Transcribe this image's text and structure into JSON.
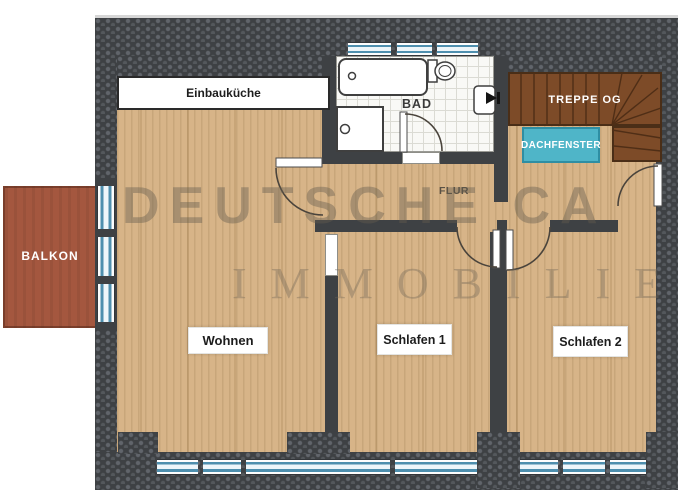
{
  "floorplan": {
    "labels": {
      "kitchen": "Einbauküche",
      "bath": "BAD",
      "stairs": "TREPPE OG",
      "roof_window": "DACHFENSTER",
      "hallway": "FLUR",
      "balcony": "BALKON",
      "living": "Wohnen",
      "bedroom1": "Schlafen 1",
      "bedroom2": "Schlafen 2"
    },
    "watermark": {
      "line1": "DEUTSCHE CA",
      "line2": "IMMOBILIE"
    },
    "colors": {
      "wall": "#3e4144",
      "wall_pebble": "#61656b",
      "wood": "#d7b488",
      "stairs_brown": "#7d4b28",
      "stair_line": "#4f2e16",
      "roof_window_fill": "#4fb5c8",
      "roof_window_border": "#2e8ea3",
      "balcony_fill": "#a4573f",
      "window_blue": "#4e8fae",
      "tile_line": "#dbdbd4",
      "label_text": "#1d1d1d"
    }
  }
}
